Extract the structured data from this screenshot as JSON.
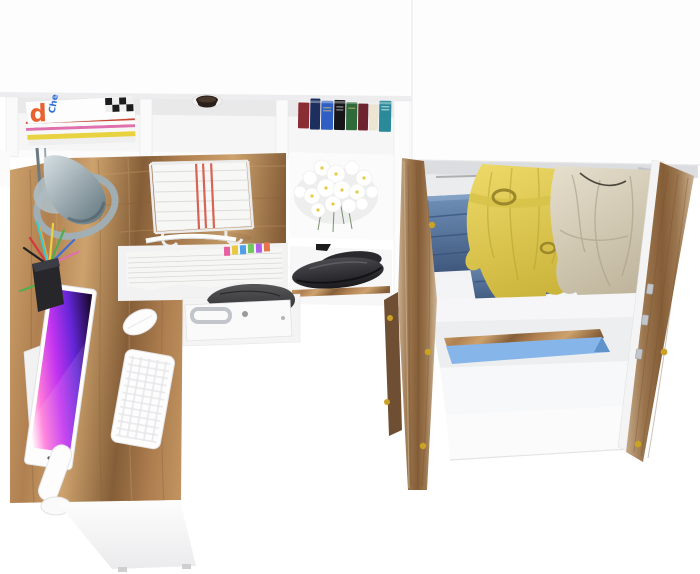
{
  "image": {
    "width": 700,
    "height": 574,
    "background": "#ffffff",
    "description": "Product render, viewed from above: white and oak L-shaped desk with hutch shelving and accessories (left) and an open two-door oak wardrobe with clothes (right)."
  },
  "palette": {
    "white_panel": "#fdfdfd",
    "panel_edge": "#e7e7e9",
    "interior_shadow": "#dcdde0",
    "shelf_gray": "#f3f3f5",
    "wood": "#b08050",
    "wood_light": "#cda26d",
    "wood_dark": "#855e38",
    "door_wood": "#9a744c",
    "door_wood_pale": "#cbb292",
    "lamp_light": "#d7e0e3",
    "lamp_dark": "#5f737c",
    "screen_dark": "#1d0b38",
    "screen_purple": "#6426d8",
    "screen_magenta": "#c233f0",
    "screen_pink": "#ff7ad9",
    "screen_glow": "#ffffff",
    "denim_light": "#6f90b8",
    "denim_dark": "#40587d",
    "jacket_light": "#eeda69",
    "jacket_dark": "#ccb53c",
    "jacket_hardware": "#9c882a",
    "coat_light": "#e6dfcd",
    "coat_dark": "#bfb59c",
    "stripe_red": "#cd4a32",
    "box_blue": "#86b5e9",
    "box_blue_dark": "#5f93cc",
    "hardware_gold": "#c9a227",
    "hardware_silver": "#c2c5c9",
    "shoe_dark": "#1b1b1e",
    "shoe_light": "#4a4a4f",
    "bag_dark": "#303032",
    "bag_light": "#565658",
    "paper_stripe_red": "#d24b3a"
  },
  "desk": {
    "label": "L-shaped desk with hutch",
    "magazines": {
      "label": "magazine stack",
      "spine_letter": "d",
      "spine_text": "Che",
      "strip_colors": [
        "#e8d23f",
        "#e06fae",
        "#cc4433",
        "#3f7fd9",
        "#efefef"
      ]
    },
    "grommet": {
      "label": "cable grommet"
    },
    "books": {
      "label": "row of books",
      "colors": [
        "#8a2c33",
        "#1d2f5e",
        "#2f5fc4",
        "#16161a",
        "#2f6b3a",
        "#6e2430",
        "#ece5d2",
        "#2a8a99"
      ]
    },
    "lamp": {
      "label": "cone desk lamp"
    },
    "paper_tray": {
      "label": "wire paper tray with red-striped documents"
    },
    "flowers": {
      "label": "white daisy bouquet"
    },
    "documents": {
      "label": "document stack with index tabs",
      "tab_colors": [
        "#e85fa0",
        "#e8c93f",
        "#4f9fe8",
        "#6fc95f",
        "#b05fe8",
        "#e8734f"
      ]
    },
    "shoes": {
      "label": "black shoes on shelf"
    },
    "bag": {
      "label": "dark pouch under desk"
    },
    "drawer": {
      "label": "white drawer with metal handle"
    },
    "monitor": {
      "label": "all-in-one monitor, purple wallpaper"
    },
    "keyboard": {
      "label": "white keyboard"
    },
    "mouse": {
      "label": "white mouse"
    },
    "pencil_cup": {
      "label": "pencil cup with pens",
      "pen_colors": [
        "#d23b3b",
        "#e8a23f",
        "#e8d23f",
        "#4fae4f",
        "#3f6fd9",
        "#222222",
        "#e06fae",
        "#3fc9c9"
      ]
    }
  },
  "wardrobe": {
    "label": "open wardrobe with oak doors",
    "clothes": {
      "jeans": "folded jeans",
      "jacket": "yellow belted jacket",
      "striped": "red striped shirt",
      "coat": "beige coat"
    },
    "shelf_item": "blue storage box",
    "doors": {
      "left": "left oak door (open)",
      "right": "right oak door (open)"
    }
  }
}
